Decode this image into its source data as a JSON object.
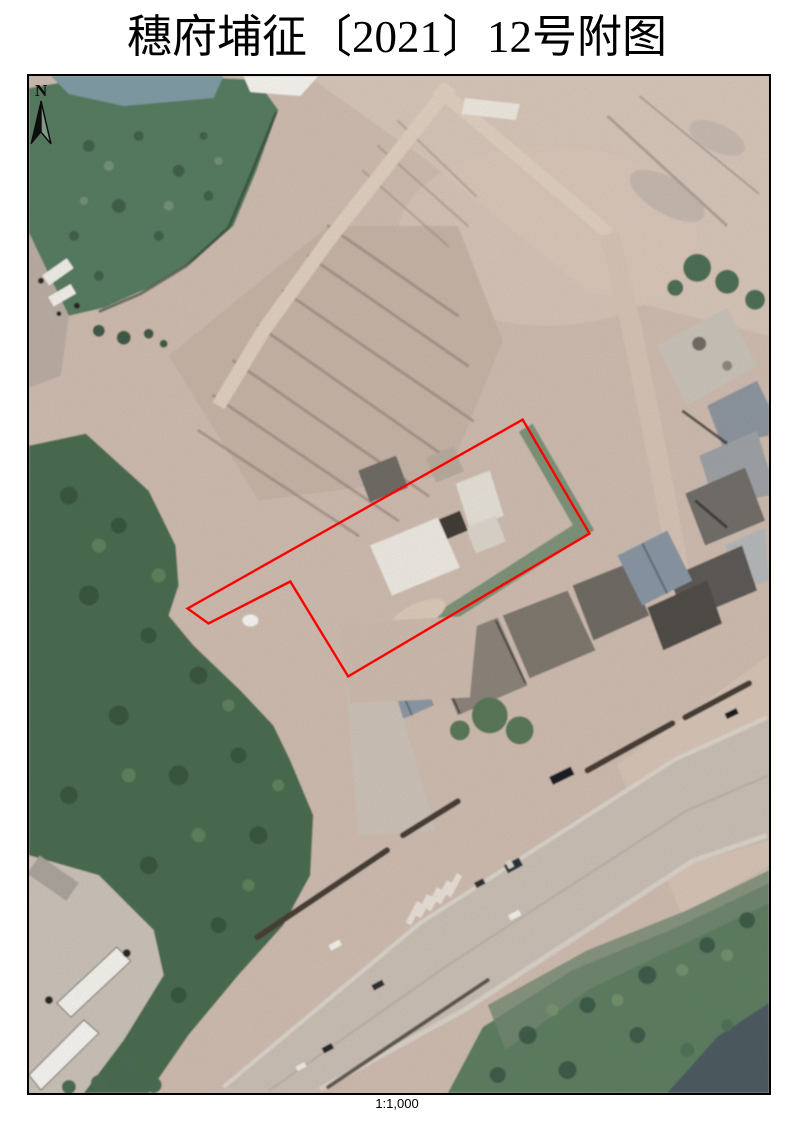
{
  "document": {
    "title": "穗府埔征〔2021〕12号附图",
    "scale_label": "1:1,000"
  },
  "map": {
    "north_label": "N",
    "boundary_color": "#FF0000",
    "parcel_boundary_points": "495,344 562,458 320,601 262,506 180,548 159,533"
  }
}
